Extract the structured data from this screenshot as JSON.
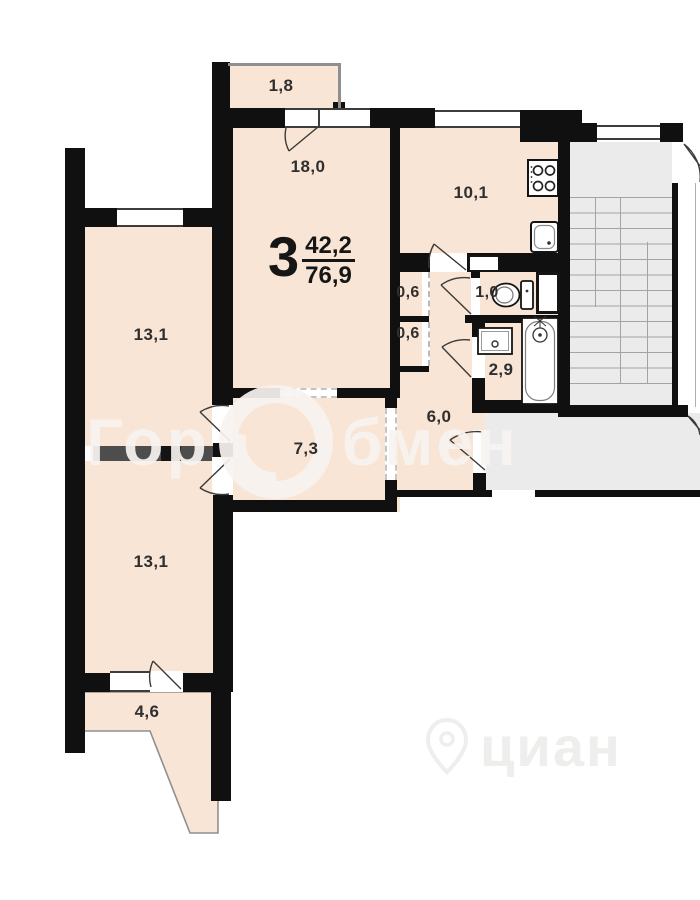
{
  "apartment": {
    "rooms_count": "3",
    "living_area": "42,2",
    "total_area": "76,9"
  },
  "rooms": [
    {
      "name": "balcony-top",
      "area": "1,8"
    },
    {
      "name": "living-room",
      "area": "18,0"
    },
    {
      "name": "kitchen",
      "area": "10,1"
    },
    {
      "name": "bedroom-upper",
      "area": "13,1"
    },
    {
      "name": "closet-a",
      "area": "0,6"
    },
    {
      "name": "closet-b",
      "area": "0,6"
    },
    {
      "name": "wc",
      "area": "1,0"
    },
    {
      "name": "bathroom",
      "area": "2,9"
    },
    {
      "name": "corridor",
      "area": "6,0"
    },
    {
      "name": "hallway",
      "area": "7,3"
    },
    {
      "name": "bedroom-lower",
      "area": "13,1"
    },
    {
      "name": "balcony-bottom",
      "area": "4,6"
    }
  ],
  "watermark": {
    "brand_full": "ГорОбмен",
    "part1": "Гор",
    "part2": "бмен",
    "footer": "циан"
  },
  "fixtures": [
    "stove-icon",
    "kitchen-sink-icon",
    "toilet-icon",
    "washbasin-icon",
    "bathtub-icon",
    "stairs-icon"
  ],
  "colors": {
    "wall": "#101010",
    "room_fill": "#f8e5d5",
    "stair_fill": "#ebebeb",
    "partition": "#4d4d4d",
    "label_text": "#2f2f2f"
  }
}
